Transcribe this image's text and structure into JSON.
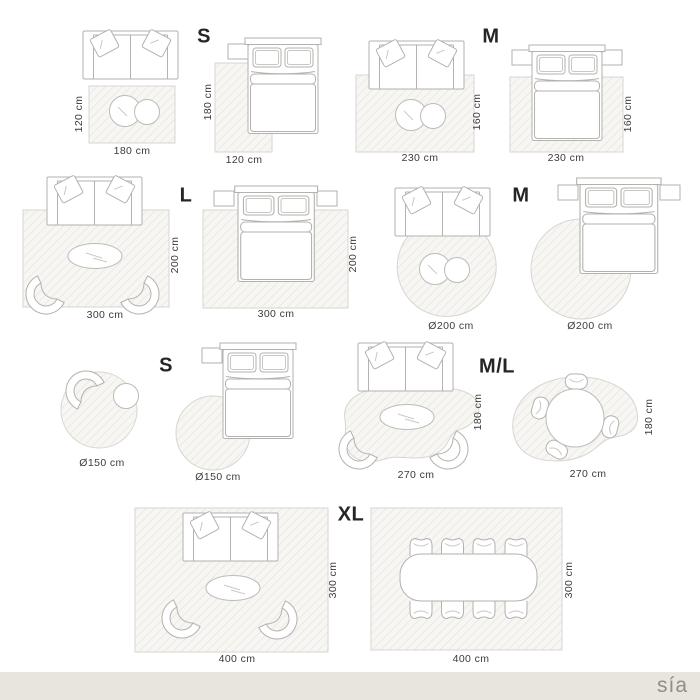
{
  "brand": "sía",
  "size_labels": [
    {
      "text": "S"
    },
    {
      "text": "M"
    },
    {
      "text": "L"
    },
    {
      "text": "M"
    },
    {
      "text": "S"
    },
    {
      "text": "M/L"
    },
    {
      "text": "XL"
    }
  ],
  "diagrams": [
    {
      "bottom": "180 cm",
      "side": "120 cm"
    },
    {
      "bottom": "120 cm",
      "side": "180 cm"
    },
    {
      "bottom": "230 cm",
      "side": "160 cm"
    },
    {
      "bottom": "230 cm",
      "side": "160 cm"
    },
    {
      "bottom": "300 cm",
      "side": "200 cm"
    },
    {
      "bottom": "300 cm",
      "side": "200 cm"
    },
    {
      "bottom": "Ø200 cm"
    },
    {
      "bottom": "Ø200 cm"
    },
    {
      "bottom": "Ø150 cm"
    },
    {
      "bottom": "Ø150 cm"
    },
    {
      "bottom": "270 cm",
      "side": "180 cm"
    },
    {
      "bottom": "270 cm",
      "side": "180 cm"
    },
    {
      "bottom": "400 cm",
      "side": "300 cm"
    },
    {
      "bottom": "400 cm",
      "side": "300 cm"
    }
  ]
}
